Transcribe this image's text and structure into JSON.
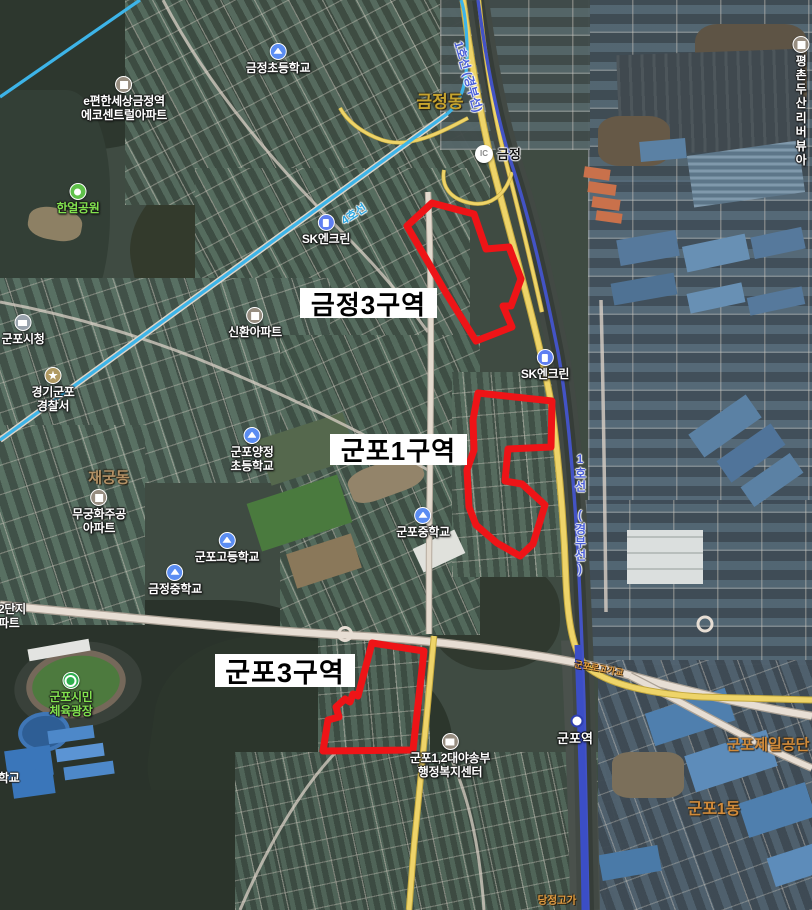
{
  "zones": [
    {
      "name": "금정3구역"
    },
    {
      "name": "군포1구역"
    },
    {
      "name": "군포3구역"
    }
  ],
  "pois": [
    {
      "name": "금정초등학교",
      "type": "school"
    },
    {
      "name": "e편한세상금정역\n에코센트럴아파트",
      "type": "apartment"
    },
    {
      "name": "한얼공원",
      "type": "park"
    },
    {
      "name": "SK엔크린",
      "type": "gas-station"
    },
    {
      "name": "군포시청",
      "type": "government"
    },
    {
      "name": "신환아파트",
      "type": "apartment"
    },
    {
      "name": "경기군포\n경찰서",
      "type": "police"
    },
    {
      "name": "군포양정\n초등학교",
      "type": "school"
    },
    {
      "name": "무궁화주공\n아파트",
      "type": "apartment"
    },
    {
      "name": "군포고등학교",
      "type": "school"
    },
    {
      "name": "금정중학교",
      "type": "school"
    },
    {
      "name": "군포중학교",
      "type": "school"
    },
    {
      "name": "SK엔크린",
      "type": "gas-station"
    },
    {
      "name": "군포시민\n체육광장",
      "type": "sports"
    },
    {
      "name": "군포1,2대야송부\n행정복지센터",
      "type": "community-center"
    },
    {
      "name": "평촌두산\n리버뷰아",
      "type": "apartment"
    }
  ],
  "districts": [
    {
      "name": "금정동"
    },
    {
      "name": "재궁동"
    },
    {
      "name": "군포제일공단"
    },
    {
      "name": "군포1동"
    }
  ],
  "transit": {
    "line4_label": "4호선",
    "line1_label": "1호선 (경부선)",
    "station": "군포역",
    "interchange_badge": "IC",
    "interchange_name": "금정"
  },
  "bridges": [
    {
      "name": "군포로고가교"
    },
    {
      "name": "당정고가"
    }
  ],
  "edge_labels": [
    {
      "name": "2단지\n파트"
    },
    {
      "name": "학교"
    }
  ],
  "colors": {
    "zone_outline": "#ee1417",
    "line1_blue": "#4353c5",
    "line4_cyan": "#3db4e8",
    "major_road_yellow": "#eed469"
  }
}
